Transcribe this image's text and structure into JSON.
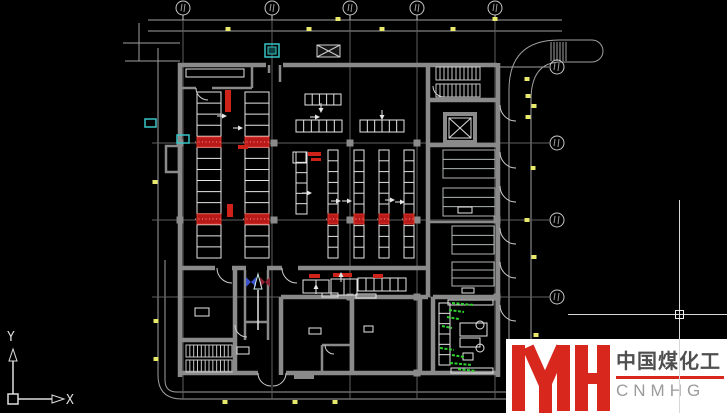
{
  "logo": {
    "mark_letters": "YH",
    "chinese": "中国煤化工",
    "latin": "CNMHG"
  },
  "ucs": {
    "x_label": "X",
    "y_label": "Y"
  },
  "colors": {
    "background": "#000000",
    "wall": "#8a8a8a",
    "dim": "#9f9f9f",
    "grid": "#5f5f5f",
    "white": "#e6e6e6",
    "bench": "#b2b6b6",
    "stair": "#c8c8c8",
    "door": "#cfcfcf",
    "red": "#cf2218",
    "red_band": "#b81a1a",
    "red_band_edge": "#e03428",
    "yellow": "#e9e96b",
    "cyan": "#38c6c6",
    "green": "#2fd32f",
    "blue_arrow": "#3a52cc",
    "maroon_arrow": "#8a2030",
    "logo_red": "#d8281e",
    "logo_cn": "#4f4f4f",
    "logo_en": "#9b9b9b"
  },
  "plan": {
    "grid": {
      "top_bubbles_x": [
        183,
        272,
        350,
        417,
        495
      ],
      "top_bubble_y": 8,
      "right_bubbles_y": [
        67,
        143,
        220,
        297
      ],
      "right_bubble_x": 557,
      "bubble_r": 7,
      "v_lines_x": [
        183,
        272,
        350,
        417,
        495
      ],
      "v_line_span": [
        16,
        399
      ],
      "h_lines_y": [
        143,
        220,
        297
      ],
      "h_line_span": [
        152,
        549
      ]
    },
    "dim_lines": [
      [
        148,
        20,
        562,
        20
      ],
      [
        148,
        31,
        562,
        31
      ],
      [
        177,
        392,
        562,
        392
      ],
      [
        182,
        399,
        565,
        399
      ],
      [
        158,
        48,
        158,
        375
      ],
      [
        165,
        260,
        165,
        380
      ],
      [
        123,
        43,
        180,
        43
      ],
      [
        125,
        61,
        180,
        61
      ],
      [
        139,
        23,
        139,
        61
      ],
      [
        498,
        67,
        549,
        67
      ]
    ],
    "dim_curves": [
      "M158 375 Q158 399 182 399",
      "M165 380 Q165 392 177 392"
    ],
    "road": {
      "paths": [
        "M509 405 L509 90 Q509 40 559 40 L592 40",
        "M531 405 L531 100 Q531 62 561 62 L592 62",
        "M592 40 A11 11 0 0 1 592 62"
      ],
      "hatch_x": [
        551,
        554,
        557,
        560,
        563,
        566
      ],
      "hatch_span": [
        42,
        61
      ]
    },
    "walls": {
      "thick": [
        [
          178,
          65,
          266,
          65
        ],
        [
          283,
          65,
          497,
          65
        ],
        [
          498,
          63,
          498,
          377
        ],
        [
          178,
          373,
          258,
          373
        ],
        [
          286,
          373,
          498,
          373
        ],
        [
          180,
          63,
          180,
          377
        ],
        [
          428,
          65,
          428,
          297
        ],
        [
          428,
          100,
          497,
          100
        ],
        [
          428,
          145,
          497,
          145
        ],
        [
          180,
          268,
          215,
          268
        ],
        [
          232,
          268,
          246,
          268
        ],
        [
          267,
          268,
          282,
          268
        ],
        [
          298,
          268,
          428,
          268
        ],
        [
          281,
          297,
          428,
          297
        ],
        [
          433,
          297,
          497,
          297
        ],
        [
          281,
          297,
          281,
          375
        ],
        [
          352,
          297,
          352,
          375
        ],
        [
          420,
          297,
          420,
          375
        ],
        [
          433,
          297,
          433,
          375
        ],
        [
          235,
          268,
          235,
          340
        ],
        [
          180,
          340,
          235,
          340
        ],
        [
          235,
          340,
          235,
          375
        ]
      ],
      "med": [
        [
          245,
          270,
          245,
          340
        ],
        [
          268,
          270,
          268,
          340
        ],
        [
          245,
          322,
          268,
          322
        ],
        [
          322,
          345,
          352,
          345
        ],
        [
          322,
          345,
          322,
          373
        ],
        [
          180,
          88,
          196,
          88
        ],
        [
          212,
          88,
          252,
          88
        ],
        [
          252,
          63,
          252,
          88
        ],
        [
          269,
          65,
          269,
          73
        ],
        [
          280,
          65,
          280,
          82
        ],
        [
          430,
          222,
          497,
          222
        ]
      ],
      "pillars": [
        [
          274,
          143
        ],
        [
          350,
          143
        ],
        [
          417,
          143
        ],
        [
          180,
          143
        ],
        [
          180,
          220
        ],
        [
          274,
          220
        ],
        [
          350,
          220
        ],
        [
          417,
          220
        ],
        [
          497,
          220
        ],
        [
          350,
          297
        ],
        [
          417,
          297
        ],
        [
          497,
          297
        ],
        [
          417,
          373
        ]
      ],
      "annex": [
        166,
        146,
        13,
        26
      ],
      "stoop": [
        294,
        373,
        20,
        6
      ],
      "elevator_outer": [
        445,
        114,
        30,
        28
      ],
      "elevator_inner": [
        449,
        118,
        22,
        20
      ]
    },
    "ladders": [
      [
        197,
        92,
        24,
        166,
        15
      ],
      [
        245,
        92,
        24,
        166,
        15
      ],
      [
        296,
        152,
        11,
        62,
        6
      ],
      [
        328,
        150,
        10,
        108,
        10
      ],
      [
        354,
        150,
        10,
        108,
        10
      ],
      [
        379,
        150,
        10,
        108,
        10
      ],
      [
        404,
        150,
        10,
        108,
        10
      ],
      [
        439,
        303,
        11,
        62,
        6
      ]
    ],
    "h_racks": [
      [
        305,
        94,
        36,
        11,
        5
      ],
      [
        296,
        120,
        46,
        12,
        6
      ],
      [
        360,
        120,
        44,
        12,
        6
      ],
      [
        303,
        280,
        26,
        13,
        2
      ],
      [
        331,
        279,
        26,
        16,
        2
      ],
      [
        358,
        278,
        48,
        13,
        6
      ]
    ],
    "benches": [
      [
        443,
        150,
        52,
        28,
        2
      ],
      [
        443,
        188,
        52,
        28,
        2
      ],
      [
        452,
        226,
        42,
        28,
        2
      ],
      [
        452,
        262,
        42,
        24,
        2
      ]
    ],
    "white_rects": [
      [
        186,
        69,
        58,
        8
      ],
      [
        195,
        308,
        14,
        8
      ],
      [
        309,
        328,
        12,
        6
      ],
      [
        364,
        326,
        9,
        6
      ],
      [
        237,
        347,
        12,
        7
      ],
      [
        322,
        293,
        16,
        4
      ],
      [
        356,
        294,
        20,
        4
      ],
      [
        458,
        207,
        14,
        6
      ],
      [
        462,
        288,
        12,
        5
      ],
      [
        293,
        152,
        13,
        11
      ],
      [
        448,
        300,
        45,
        5
      ],
      [
        451,
        368,
        42,
        5
      ],
      [
        460,
        323,
        27,
        13
      ],
      [
        460,
        338,
        20,
        9
      ],
      [
        463,
        353,
        10,
        7
      ]
    ],
    "circles": [
      [
        480,
        325,
        4
      ],
      [
        480,
        348,
        4
      ]
    ],
    "stairs": [
      [
        436,
        67,
        44,
        13,
        11
      ],
      [
        436,
        84,
        44,
        13,
        11
      ],
      [
        186,
        345,
        46,
        12,
        12
      ],
      [
        186,
        360,
        46,
        12,
        12
      ]
    ],
    "canopy_x": [
      317,
      45,
      23,
      12
    ],
    "cyan_boxes": [
      [
        265,
        44,
        14,
        13
      ],
      [
        177,
        135,
        12,
        8
      ],
      [
        145,
        119,
        11,
        8
      ]
    ],
    "red_bands": [
      [
        197,
        137,
        24,
        10
      ],
      [
        245,
        137,
        24,
        10
      ],
      [
        197,
        214,
        24,
        10
      ],
      [
        245,
        214,
        24,
        10
      ],
      [
        328,
        214,
        10,
        10
      ],
      [
        354,
        214,
        10,
        10
      ],
      [
        379,
        214,
        10,
        10
      ],
      [
        404,
        214,
        10,
        10
      ]
    ],
    "red_labels": [
      [
        225,
        90,
        6,
        22
      ],
      [
        227,
        204,
        6,
        13
      ],
      [
        238,
        145,
        10,
        4
      ],
      [
        308,
        152,
        13,
        4
      ],
      [
        311,
        158,
        10,
        3
      ],
      [
        309,
        274,
        11,
        4
      ],
      [
        333,
        273,
        19,
        4
      ],
      [
        373,
        274,
        10,
        4
      ]
    ],
    "green_notes": [
      [
        452,
        303,
        22
      ],
      [
        449,
        310,
        15
      ],
      [
        447,
        317,
        12
      ],
      [
        442,
        326,
        10
      ],
      [
        440,
        348,
        14
      ],
      [
        452,
        355,
        12
      ],
      [
        450,
        363,
        22
      ],
      [
        458,
        369,
        18
      ]
    ],
    "yellow_markers": [
      [
        228,
        29
      ],
      [
        309,
        29
      ],
      [
        338,
        19
      ],
      [
        382,
        29
      ],
      [
        453,
        29
      ],
      [
        495,
        19
      ],
      [
        527,
        79
      ],
      [
        528,
        96
      ],
      [
        534,
        106
      ],
      [
        528,
        117
      ],
      [
        533,
        168
      ],
      [
        527,
        220
      ],
      [
        534,
        257
      ],
      [
        536,
        335
      ],
      [
        155,
        182
      ],
      [
        156,
        321
      ],
      [
        156,
        359
      ],
      [
        225,
        402
      ],
      [
        295,
        402
      ],
      [
        335,
        402
      ]
    ],
    "arrows": [
      [
        223,
        116,
        "r"
      ],
      [
        239,
        128,
        "r"
      ],
      [
        321,
        109,
        "d"
      ],
      [
        316,
        117,
        "r"
      ],
      [
        382,
        116,
        "d"
      ],
      [
        308,
        193,
        "r"
      ],
      [
        337,
        201,
        "r"
      ],
      [
        348,
        201,
        "r"
      ],
      [
        391,
        200,
        "r"
      ],
      [
        401,
        202,
        "r"
      ],
      [
        341,
        276,
        "u"
      ],
      [
        316,
        288,
        "u"
      ]
    ],
    "doors": [
      [
        500,
        105,
        516,
        121,
        16,
        0
      ],
      [
        500,
        152,
        516,
        168,
        16,
        0
      ],
      [
        500,
        186,
        516,
        202,
        16,
        0
      ],
      [
        500,
        228,
        516,
        244,
        16,
        0
      ],
      [
        500,
        262,
        516,
        278,
        16,
        0
      ],
      [
        500,
        305,
        516,
        321,
        16,
        0
      ],
      [
        217,
        268,
        232,
        283,
        15,
        0
      ],
      [
        282,
        268,
        297,
        283,
        15,
        0
      ],
      [
        258,
        373,
        271,
        386,
        13,
        0
      ],
      [
        286,
        373,
        273,
        386,
        13,
        1
      ],
      [
        196,
        88,
        208,
        100,
        12,
        0
      ],
      [
        235,
        325,
        247,
        337,
        12,
        0
      ],
      [
        433,
        86,
        444,
        97,
        11,
        0
      ],
      [
        325,
        345,
        334,
        354,
        9,
        0
      ]
    ],
    "flow_arrows": {
      "blue": [
        246,
        277
      ],
      "maroon": [
        260,
        277
      ],
      "shaft": [
        258,
        290,
        258,
        330
      ]
    },
    "ucs_origin": [
      8,
      394
    ],
    "cursor": {
      "x": 679,
      "y": 314
    }
  }
}
